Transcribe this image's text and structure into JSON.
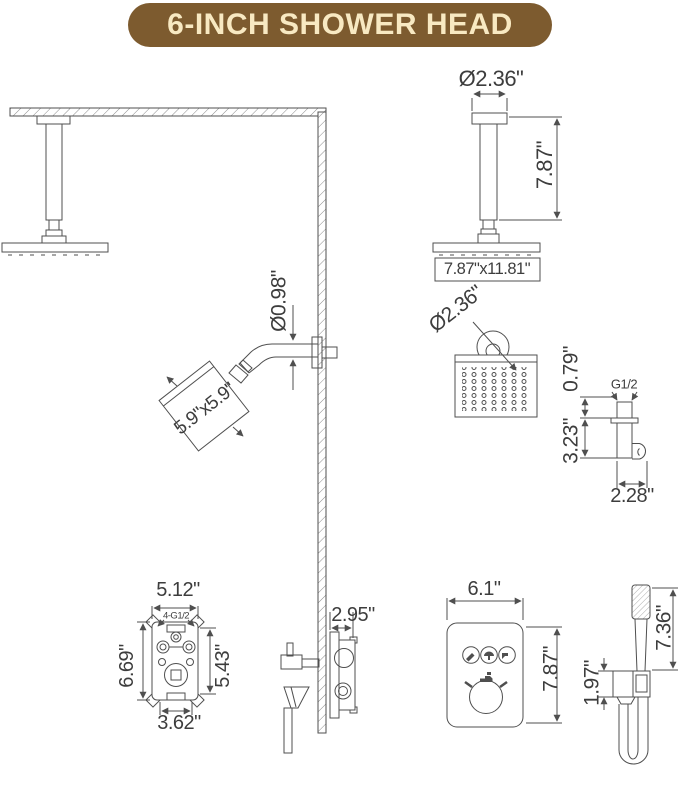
{
  "banner": {
    "title": "6-INCH SHOWER HEAD"
  },
  "colors": {
    "banner_bg": "#7d5b2f",
    "banner_text": "#f8e9c2",
    "line": "#4f4f4f",
    "text": "#3d3d3d"
  },
  "dims": {
    "ceiling_head": {
      "arm_diameter": "Ø2.36\"",
      "drop_height": "7.87\"",
      "face_size": "7.87\"x11.81\""
    },
    "wall_head": {
      "arm_diameter": "Ø0.98\"",
      "face_size": "5.9\"x5.9\"",
      "head_diameter": "Ø2.36\""
    },
    "holder": {
      "thread": "G1/2",
      "inlet_height": "0.79\"",
      "body_height": "3.23\"",
      "depth": "2.28\""
    },
    "valve": {
      "outer_width": "5.12\"",
      "ports": "4-G1/2",
      "outer_height": "6.69\"",
      "inner_height": "5.43\"",
      "inner_width": "3.62\"",
      "trim_depth": "2.95\""
    },
    "panel": {
      "width": "6.1\"",
      "height": "7.87\"",
      "button_icons": [
        "handheld-mode-icon",
        "rain-mode-icon",
        "spout-mode-icon"
      ],
      "knob_icon": "temperature-knob-icon"
    },
    "hand_shower": {
      "wand_length": "7.36\"",
      "bracket_height": "1.97\""
    }
  }
}
